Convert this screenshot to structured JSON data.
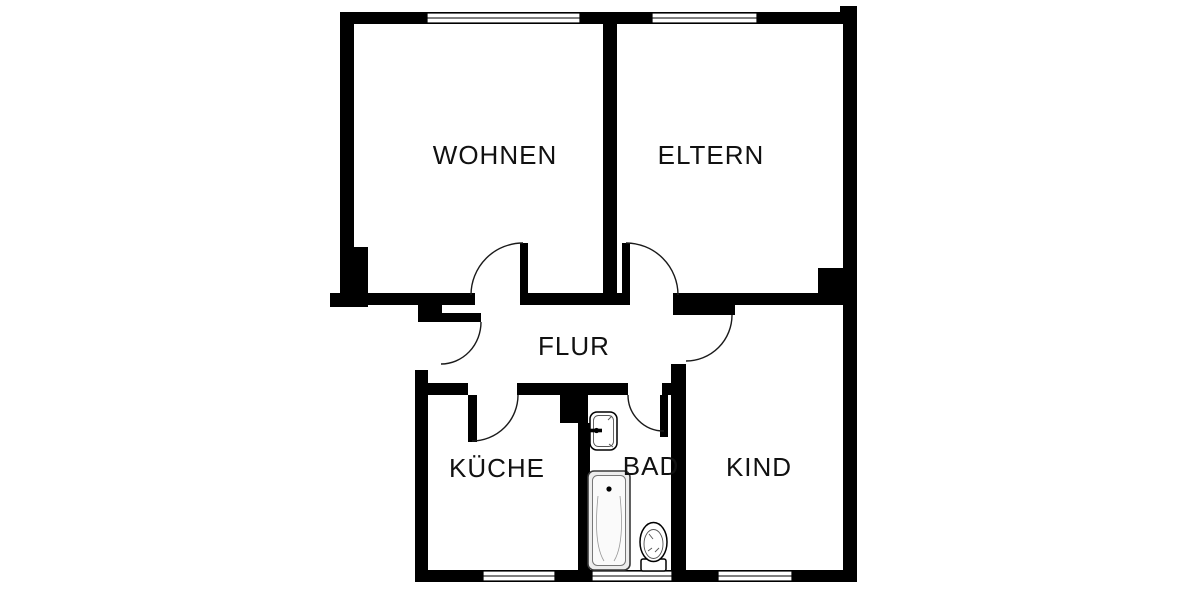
{
  "floorplan": {
    "rooms": [
      {
        "id": "wohnen",
        "label": "WOHNEN"
      },
      {
        "id": "eltern",
        "label": "ELTERN"
      },
      {
        "id": "flur",
        "label": "FLUR"
      },
      {
        "id": "kueche",
        "label": "KÜCHE"
      },
      {
        "id": "bad",
        "label": "BAD"
      },
      {
        "id": "kind",
        "label": "KIND"
      }
    ],
    "fixtures": [
      {
        "id": "sink",
        "name": "washbasin-icon"
      },
      {
        "id": "bathtub",
        "name": "bathtub-icon"
      },
      {
        "id": "toilet",
        "name": "toilet-icon"
      }
    ],
    "window_count": 5,
    "door_count": 6,
    "colors": {
      "wall": "#000000",
      "background": "#ffffff",
      "line": "#1a1a1a",
      "bathtub_fill": "#ededed"
    }
  }
}
